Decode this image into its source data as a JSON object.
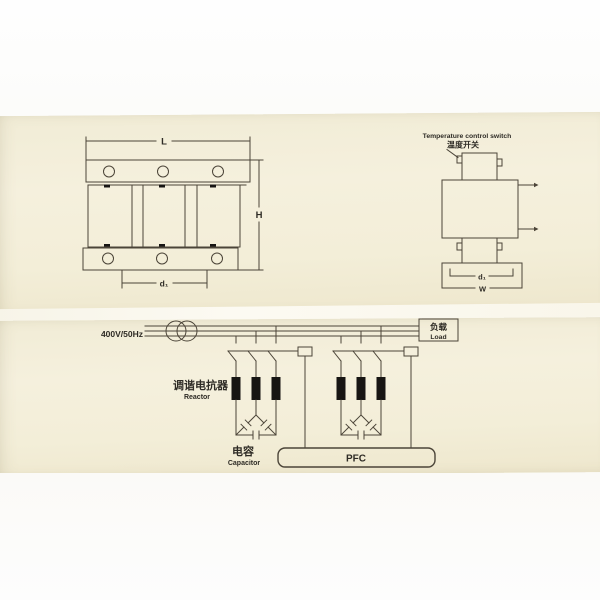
{
  "front_view": {
    "label_length": "L",
    "label_height": "H",
    "label_hole_spacing": "d₁"
  },
  "side_view": {
    "title_en": "Temperature control switch",
    "title_zh": "温度开关",
    "label_base_inner": "d₁",
    "label_base_width": "W"
  },
  "circuit": {
    "supply": "400V/50Hz",
    "load_zh": "负载",
    "load_en": "Load",
    "reactor_zh": "调谐电抗器",
    "reactor_en": "Reactor",
    "capacitor_zh": "电容",
    "capacitor_en": "Capacitor",
    "pfc_label": "PFC"
  }
}
